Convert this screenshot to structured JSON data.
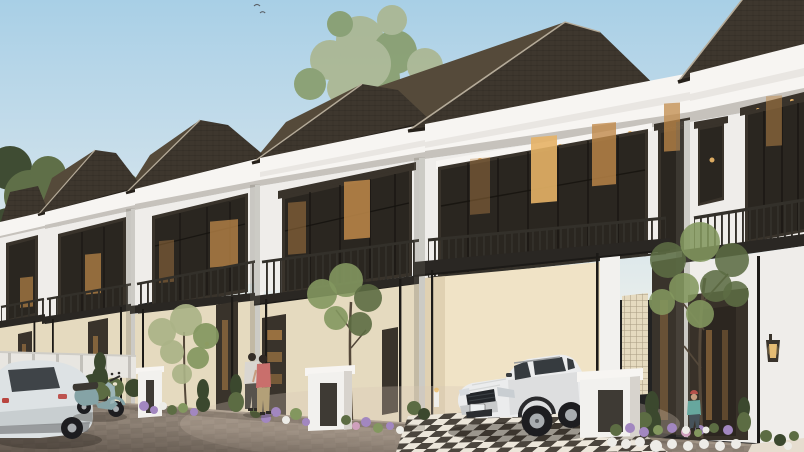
{
  "meta": {
    "type": "architectural-exterior-render",
    "style": "modern classic townhouse row, late-afternoon clear sky"
  },
  "scene": {
    "description": "3D exterior render of a row of six identical two-storey modern-classic townhouses receding in perspective to the left. Each unit has a dark brown shingled hip roof, a thick white cornice band, large dark-framed upper windows with warm interior lighting, a balcony with dark metal railings above a flat dark carport canopy on thin black posts, cream lower walls, white gate pillars, and landscaped beds with purple and white flowers. A white SUV is parked in the nearest carport, a teal scooter and a white hatchback stand at the left edge of the paver driveway, a couple stands at one entrance door and a child in teal stands near the flower bed on the right. A pale leafy tree rises behind the roofs at top-center and two small birds fly in the pale blue sky.",
    "sky": "clear pale blue, lighter toward the horizon",
    "units_count": 6,
    "birds_count": 2,
    "house_features": [
      "dark shingled hip roof",
      "white classical cornice band",
      "upper glass wall with dark mullions and warm lights",
      "balcony with dark iron railing",
      "flat dark carport canopy on slim posts",
      "downlight awnings over windows",
      "cream lower walls",
      "white gate pillars",
      "wall lantern sconce",
      "breeze-block lattice panel",
      "checkered carport floor"
    ],
    "vehicles": [
      "white SUV parked under nearest carport",
      "teal classic scooter",
      "white hatchback at left edge"
    ],
    "people": [
      "man in light shirt at entrance",
      "woman in pink top and khaki skirt at entrance",
      "child in teal with red cap near flower bed"
    ],
    "landscaping": [
      "pale leafy tree behind roofs",
      "dark green tree at left edge",
      "slender courtyard trees",
      "dark cypress shrubs",
      "purple, pink and white flower beds",
      "low hedges"
    ],
    "ground": "brick paver driveway, darker toward bottom-left corner"
  },
  "palette": {
    "sky_top": "#a8cfe6",
    "sky_mid": "#cadfeb",
    "sky_low": "#e7edeb",
    "roof": "#3e372e",
    "roof_hi": "#554a3a",
    "roof_edge": "#26211b",
    "roof_trim": "#b5ab99",
    "band_hi": "#f7f5f2",
    "band": "#e9e6e2",
    "band_sh": "#c6c2bc",
    "wall_white": "#efedea",
    "wall_shade": "#d7d3cd",
    "wall_cream": "#e5dabf",
    "cream_lit": "#f0e3c6",
    "cream_sh": "#cdbfa2",
    "frame": "#39332b",
    "glass": "#2a2620",
    "glow": "#c08a4a",
    "glow_hi": "#e6b266",
    "rail": "#33302a",
    "canopy": "#2a2723",
    "post": "#1c1a17",
    "pillar": "#f2f1ee",
    "niche": "#3e3a34",
    "road": "#9b8e81",
    "road_hi": "#c3b5a5",
    "road_dk": "#5f564e",
    "floor": "#ece6da",
    "chk": "#3b352d",
    "green": "#5c6c43",
    "green_dk": "#3b482e",
    "green_li": "#83975f",
    "green_pale": "#aab387",
    "trunk": "#54483a",
    "fl_purple": "#a287c0",
    "fl_white": "#edece7",
    "fl_pink": "#cfa0bd",
    "suv": "#ebeced",
    "suv_sh": "#c8cacb",
    "suv_glass": "#363b3f",
    "tire": "#1d1d20",
    "rim": "#a9adb0",
    "car2": "#dde2e4",
    "scooter": "#85a3a6",
    "scooter_hi": "#9db5b7",
    "skin": "#c69c7e",
    "shirt_light": "#d9d6d1",
    "pink": "#c96f6c",
    "khaki": "#b3a078",
    "dk_cloth": "#57534c",
    "teal_cloth": "#67a79e",
    "cap": "#b5504a",
    "slate": "#46525a",
    "lamp_glow": "#ecc277",
    "fence": "#e8e6e1"
  }
}
